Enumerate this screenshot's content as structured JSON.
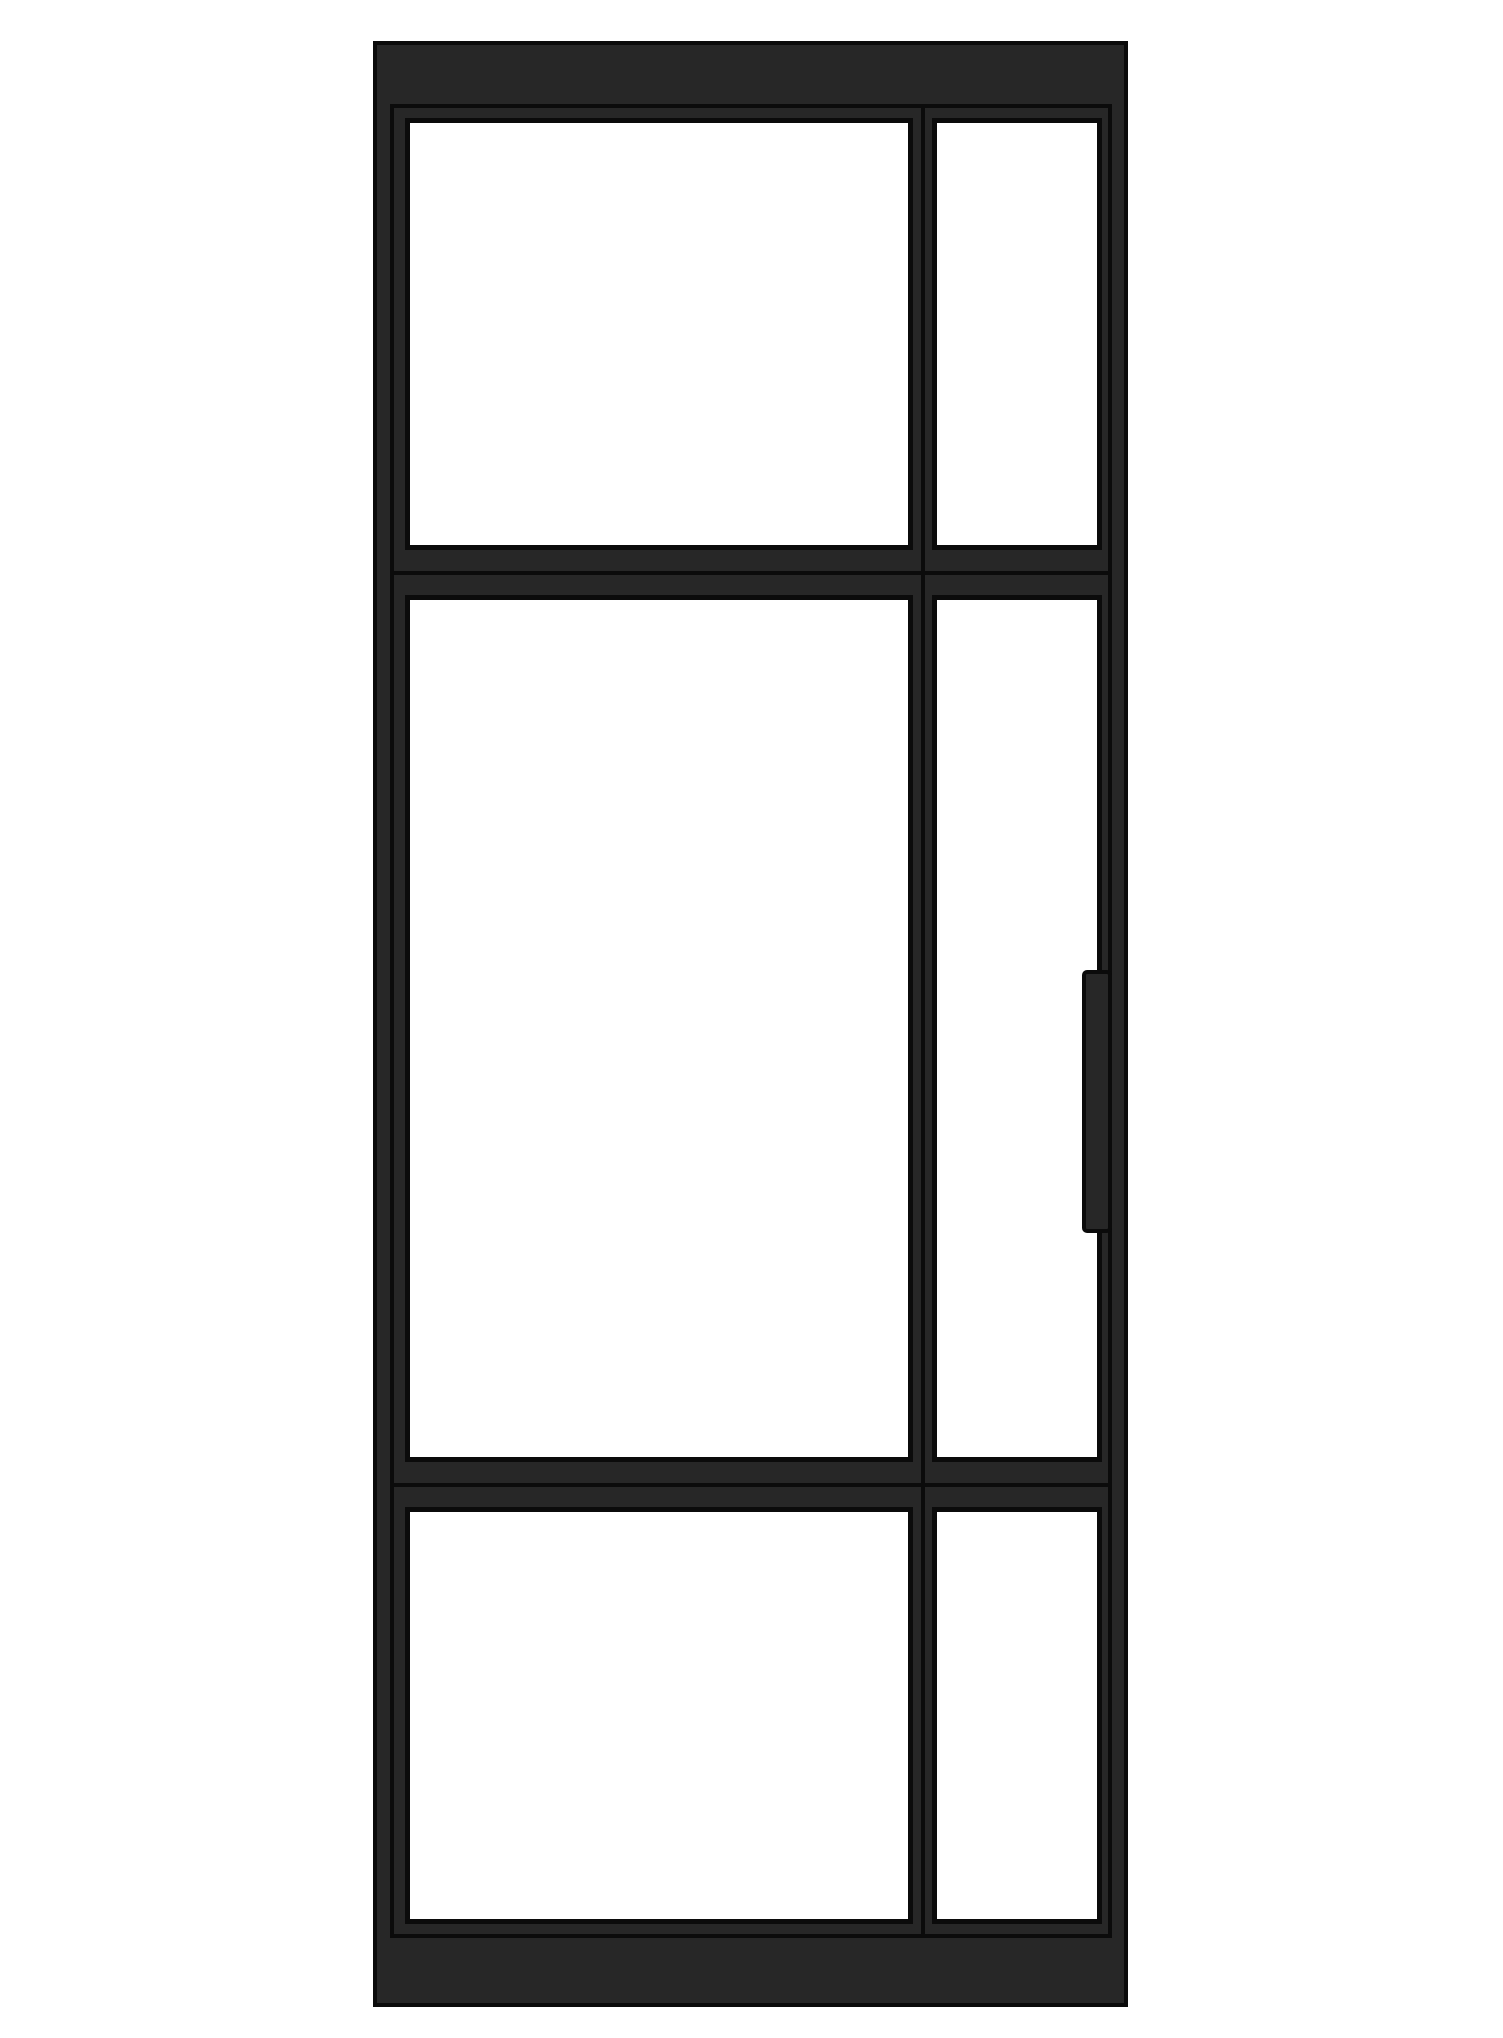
{
  "figure": {
    "kind": "steel-framed-glass-door-elevation",
    "colors": {
      "background": "#ffffff",
      "frame": "#272727",
      "outline": "#0b0b0b",
      "glass": "#ffffff"
    },
    "door": {
      "x": 373,
      "y": 41,
      "w": 755,
      "h": 1966
    },
    "head_rail": {
      "x": 0,
      "y": 0,
      "w": 755,
      "h": 66
    },
    "kick_rail": {
      "x": 0,
      "y": 1894,
      "w": 755,
      "h": 72
    },
    "sash_outline": {
      "x": 17,
      "y": 63,
      "w": 722,
      "h": 1834
    },
    "mullion_joint_line": {
      "x": 548,
      "y": 63,
      "w": 4,
      "h": 1834
    },
    "transom_joint_line_upper": {
      "x": 17,
      "y": 530,
      "w": 722,
      "h": 4
    },
    "transom_joint_line_lower": {
      "x": 17,
      "y": 1442,
      "w": 722,
      "h": 4
    },
    "handle": {
      "x": 709,
      "y": 929,
      "w": 30,
      "h": 263
    },
    "panes": [
      {
        "name": "glass-pane-top-left",
        "x": 32,
        "y": 77,
        "w": 508,
        "h": 432
      },
      {
        "name": "glass-pane-top-right",
        "x": 559,
        "y": 77,
        "w": 170,
        "h": 432
      },
      {
        "name": "glass-pane-middle-left",
        "x": 32,
        "y": 554,
        "w": 508,
        "h": 867
      },
      {
        "name": "glass-pane-middle-right",
        "x": 559,
        "y": 554,
        "w": 170,
        "h": 867
      },
      {
        "name": "glass-pane-bottom-left",
        "x": 32,
        "y": 1466,
        "w": 508,
        "h": 417
      },
      {
        "name": "glass-pane-bottom-right",
        "x": 559,
        "y": 1466,
        "w": 170,
        "h": 417
      }
    ]
  }
}
